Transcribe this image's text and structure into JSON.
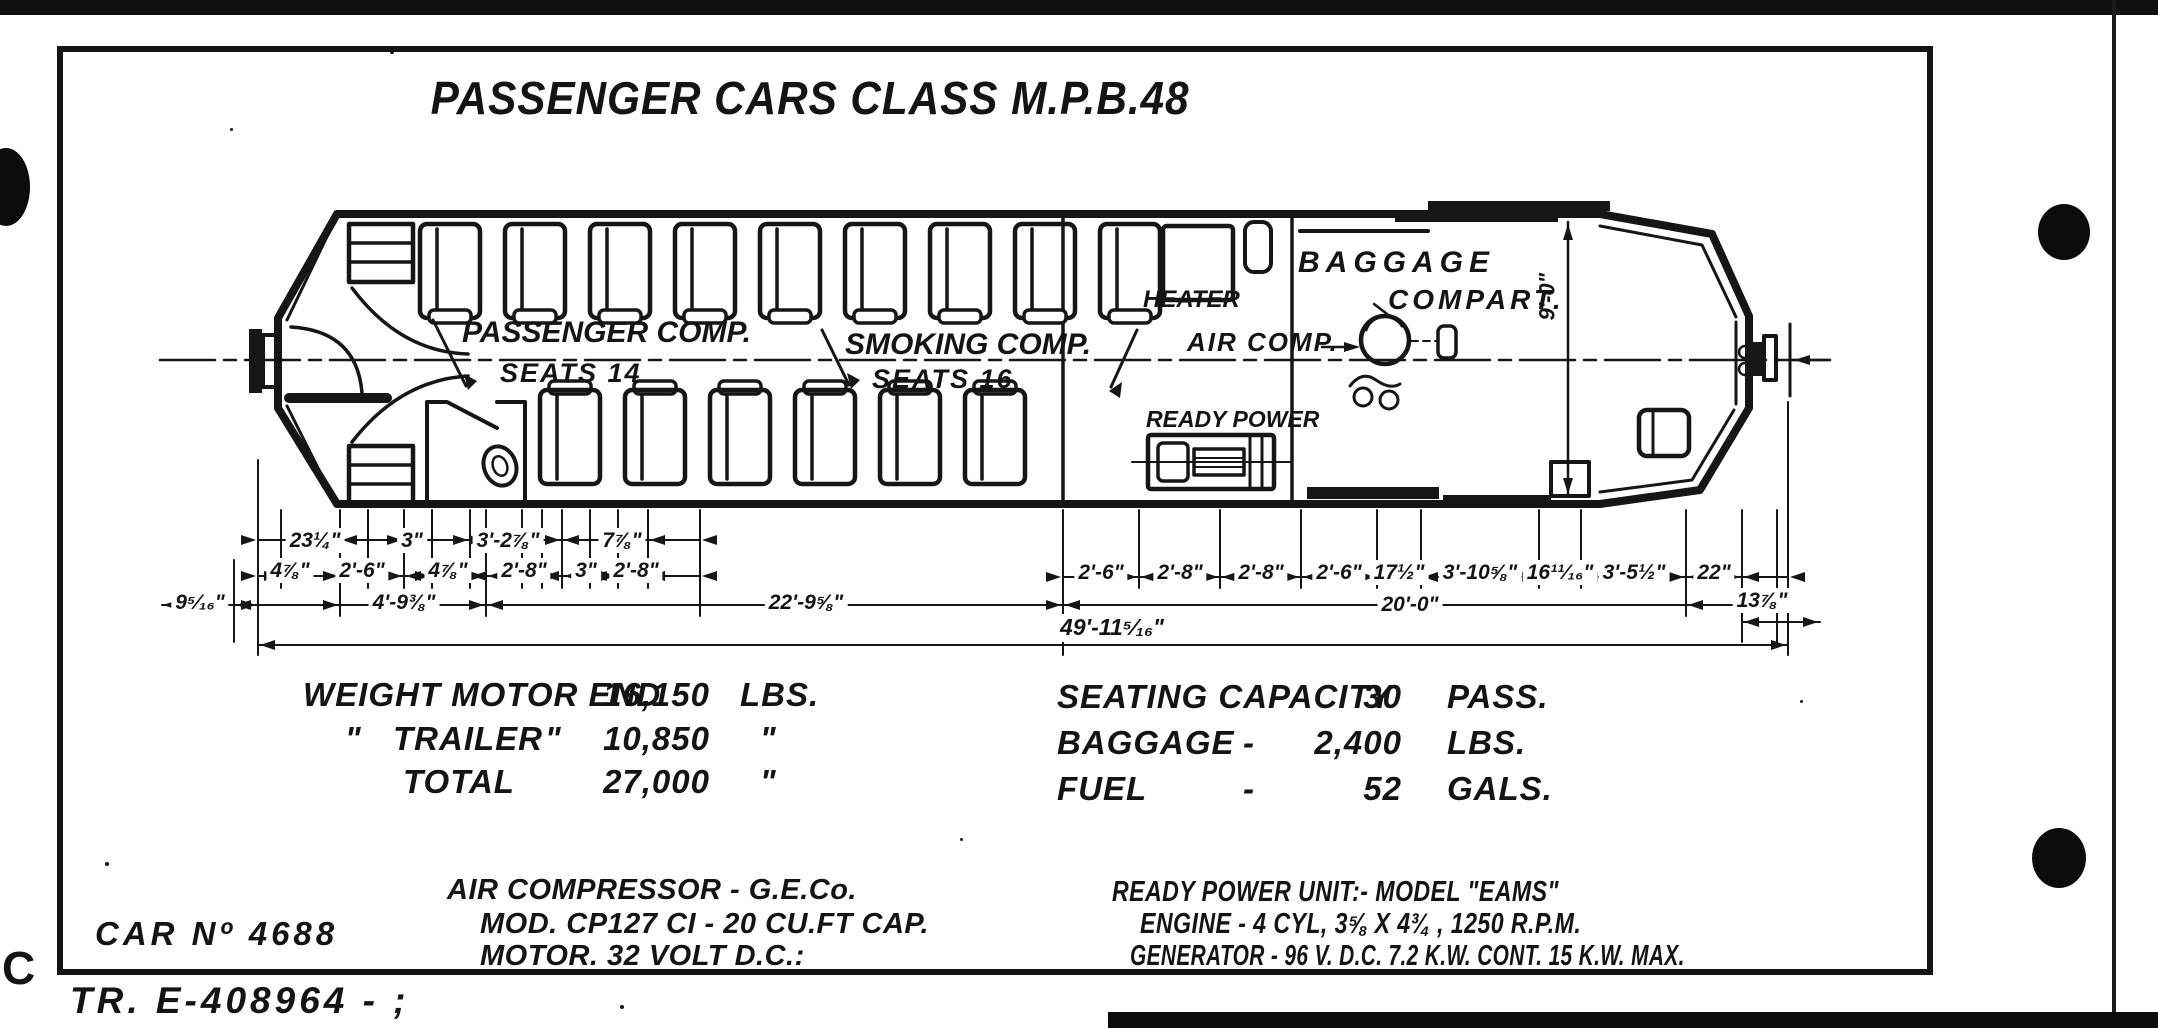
{
  "doc": {
    "title": "PASSENGER CARS CLASS M.P.B.48",
    "drawing_number": "TR. E-408964 - ;",
    "margin_letter": "C"
  },
  "plan": {
    "passenger_comp": "PASSENGER COMP.",
    "passenger_seats": "SEATS 14",
    "smoking_comp": "SMOKING COMP.",
    "smoking_seats": "SEATS 16",
    "heater": "HEATER",
    "baggage_line1": "BAGGAGE",
    "baggage_line2": "COMPART.",
    "air_comp": "AIR COMP.",
    "ready_power": "READY POWER",
    "car_width": "9'-0\""
  },
  "dimensions": {
    "row1": [
      "23¼\"",
      "3\"",
      "3'-2⅞\"",
      "7⅞\""
    ],
    "row2": [
      "4⅞\"",
      "2'-6\"",
      "4⅞\"",
      "2'-8\"",
      "3\"",
      "2'-8\""
    ],
    "row3": [
      "9⁵⁄₁₆\"",
      "4'-9⅜\"",
      "22'-9⅝\"",
      "20'-0\"",
      "13⅞\""
    ],
    "right_row": [
      "2'-6\"",
      "2'-8\"",
      "2'-8\"",
      "2'-6\"",
      "17½\"",
      "3'-10⅝\"",
      "16¹¹⁄₁₆\"",
      "3'-5½\"",
      "22\""
    ],
    "overall": "49'-11⁵⁄₁₆\""
  },
  "weights": {
    "rows": [
      {
        "label": "WEIGHT MOTOR END",
        "value": "16,150",
        "unit": "LBS."
      },
      {
        "pre": "\"",
        "label": "TRAILER",
        "post": "\"",
        "value": "10,850",
        "unit": "\""
      },
      {
        "label": "TOTAL",
        "value": "27,000",
        "unit": "\""
      }
    ]
  },
  "capacity": {
    "rows": [
      {
        "label": "SEATING CAPACITY",
        "dash": "",
        "value": "30",
        "unit": "PASS."
      },
      {
        "label": "BAGGAGE",
        "dash": "-",
        "value": "2,400",
        "unit": "LBS."
      },
      {
        "label": "FUEL",
        "dash": "-",
        "value": "52",
        "unit": "GALS."
      }
    ]
  },
  "notes": {
    "car_number": "CAR Nº 4688",
    "air_compressor": {
      "line1": "AIR COMPRESSOR - G.E.Co.",
      "line2": "MOD. CP127 CI - 20 CU.FT CAP.",
      "line3": "MOTOR. 32 VOLT D.C.:"
    },
    "ready_power_unit": {
      "line1": "READY POWER UNIT:- MODEL \"EAMS\"",
      "line2": "ENGINE - 4 CYL, 3⅝ X 4¾ , 1250 R.P.M.",
      "line3": "GENERATOR - 96 V. D.C. 7.2 K.W. CONT. 15 K.W. MAX."
    }
  }
}
